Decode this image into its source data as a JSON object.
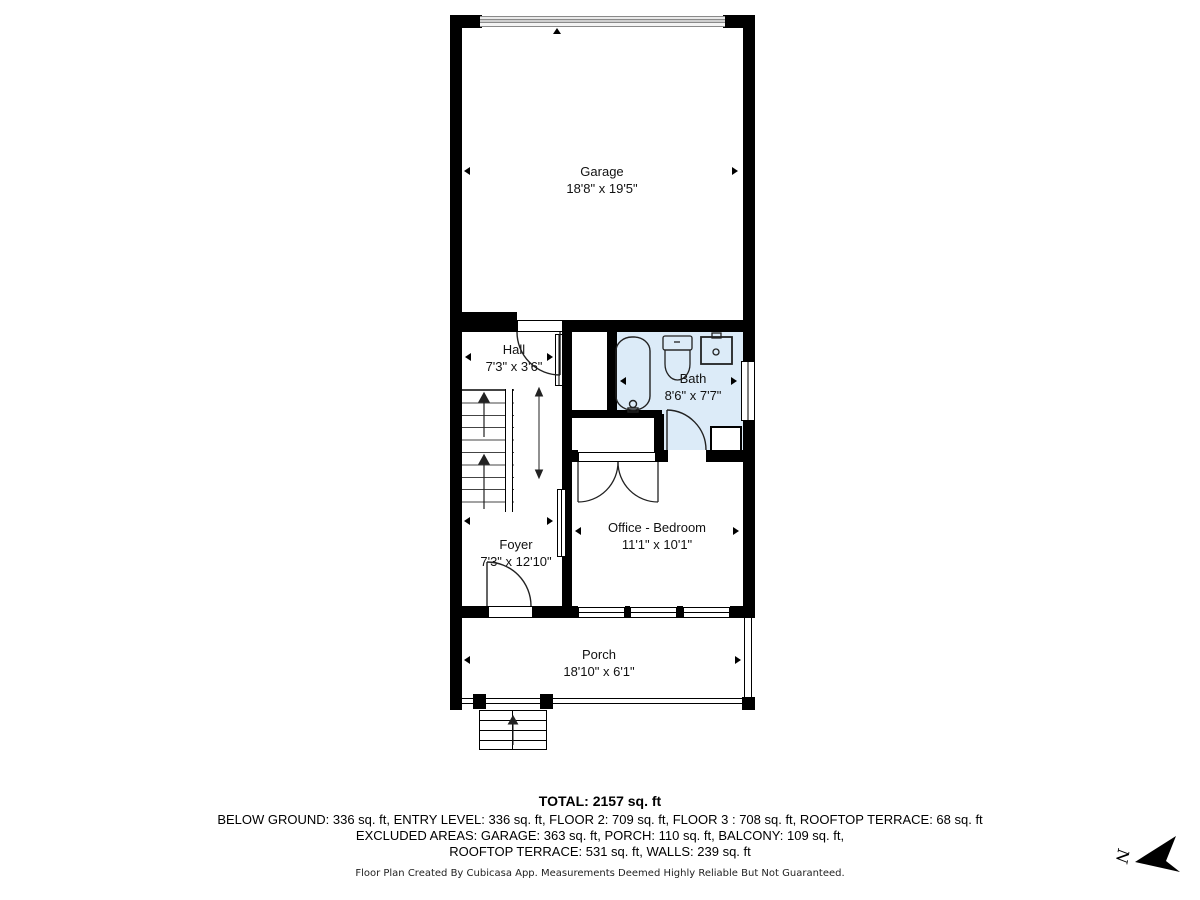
{
  "plan": {
    "rooms": [
      {
        "name": "Garage",
        "dims": "18'8\" x 19'5\""
      },
      {
        "name": "Hall",
        "dims": "7'3\" x 3'6\""
      },
      {
        "name": "Bath",
        "dims": "8'6\" x 7'7\""
      },
      {
        "name": "Office - Bedroom",
        "dims": "11'1\" x 10'1\""
      },
      {
        "name": "Foyer",
        "dims": "7'3\" x 12'10\""
      },
      {
        "name": "Porch",
        "dims": "18'10\" x 6'1\""
      }
    ],
    "colors": {
      "wall": "#000000",
      "bath_fill": "#dcebf8",
      "garage_door_gray": "#8a8a8a"
    }
  },
  "summary": {
    "total": "TOTAL: 2157 sq. ft",
    "line1": "BELOW GROUND: 336 sq. ft, ENTRY LEVEL: 336 sq. ft, FLOOR 2: 709 sq. ft, FLOOR 3 : 708 sq. ft, ROOFTOP TERRACE: 68 sq. ft",
    "line2": "EXCLUDED AREAS: GARAGE: 363 sq. ft, PORCH: 110 sq. ft, BALCONY: 109 sq. ft,",
    "line3": "ROOFTOP TERRACE: 531 sq. ft, WALLS: 239 sq. ft"
  },
  "footer": {
    "disclaimer": "Floor Plan Created By Cubicasa App. Measurements Deemed Highly Reliable But Not Guaranteed."
  },
  "compass": {
    "label": "N"
  }
}
